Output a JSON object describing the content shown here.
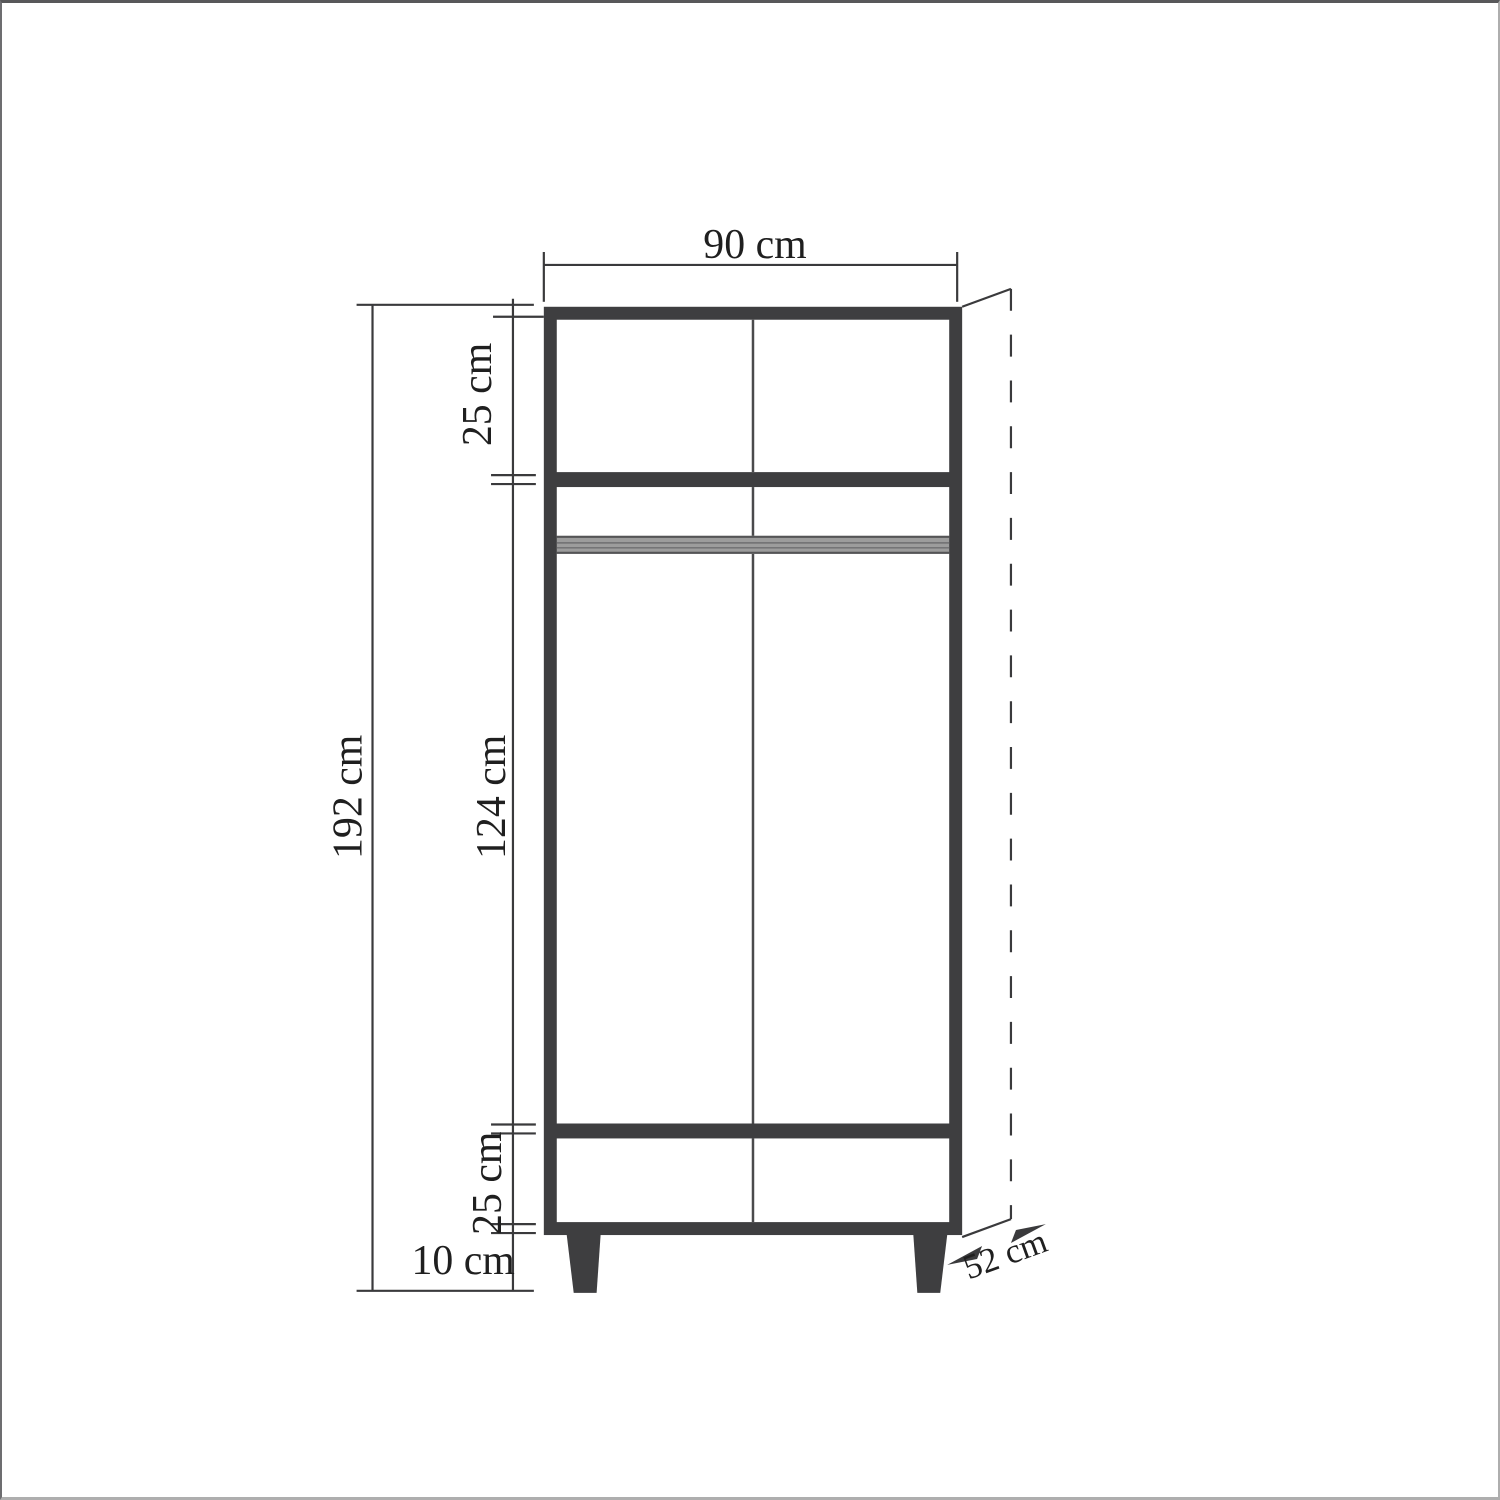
{
  "diagram": {
    "subject": "two-door wardrobe front elevation technical drawing",
    "unit": "cm",
    "width_label": "90 cm",
    "height_label": "192 cm",
    "top_section_label": "25 cm",
    "middle_section_label": "124 cm",
    "bottom_section_label": "25 cm",
    "leg_height_label": "10 cm",
    "depth_label": "52 cm",
    "values": {
      "width": 90,
      "total_height": 192,
      "top_section": 25,
      "middle_section": 124,
      "bottom_section": 25,
      "leg_height": 10,
      "depth": 52
    }
  },
  "colors": {
    "frame": "#3e3e40",
    "panel_line": "#4a4a4c",
    "rail_fill": "#9c9c9c",
    "rail_line_dark": "#545456",
    "rail_line_mid": "#6e6e70",
    "dimension": "#3a3a3c",
    "text": "#1f1f1f",
    "background": "#ffffff"
  }
}
